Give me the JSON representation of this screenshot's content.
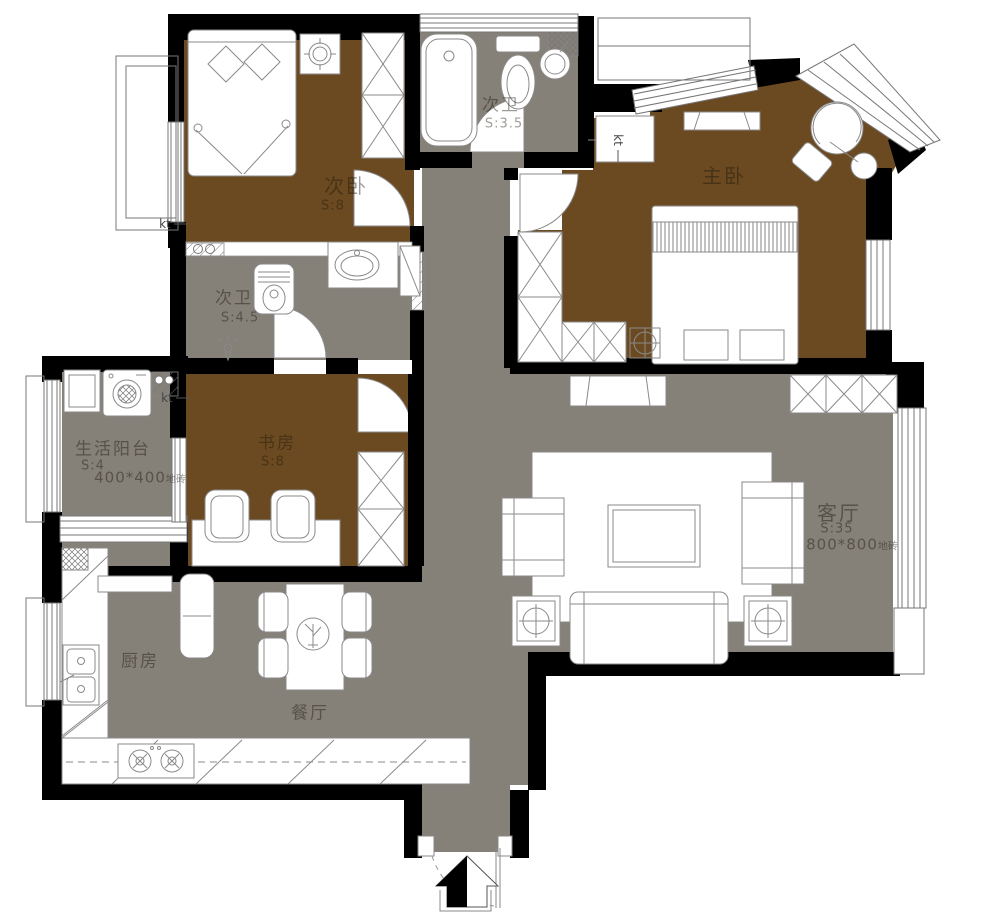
{
  "colors": {
    "floor_bedroom_brown": "#6B4A22",
    "floor_tiled_gray": "#858078",
    "wall_black": "#000000",
    "fixture_stroke": "#8a8a8a"
  },
  "rooms": {
    "secondary_bedroom_top": {
      "name": "次卧",
      "area": "S:8"
    },
    "bathroom_top": {
      "name": "次卫",
      "area": "S:3.5"
    },
    "master_bedroom": {
      "name": "主卧"
    },
    "bathroom_mid": {
      "name": "次卫",
      "area": "S:4.5"
    },
    "study": {
      "name": "书房",
      "area": "S:8"
    },
    "service_balcony": {
      "name": "生活阳台",
      "area": "S:4",
      "tile": "400*400",
      "tile_unit": "地砖"
    },
    "living_room": {
      "name": "客厅",
      "area": "S:35",
      "tile": "800*800",
      "tile_unit": "地砖"
    },
    "kitchen": {
      "name": "厨房"
    },
    "dining_room": {
      "name": "餐厅"
    }
  },
  "annotations": {
    "kt_upper": "kt",
    "kt_balcony": "kt",
    "kt_master": "kt"
  }
}
